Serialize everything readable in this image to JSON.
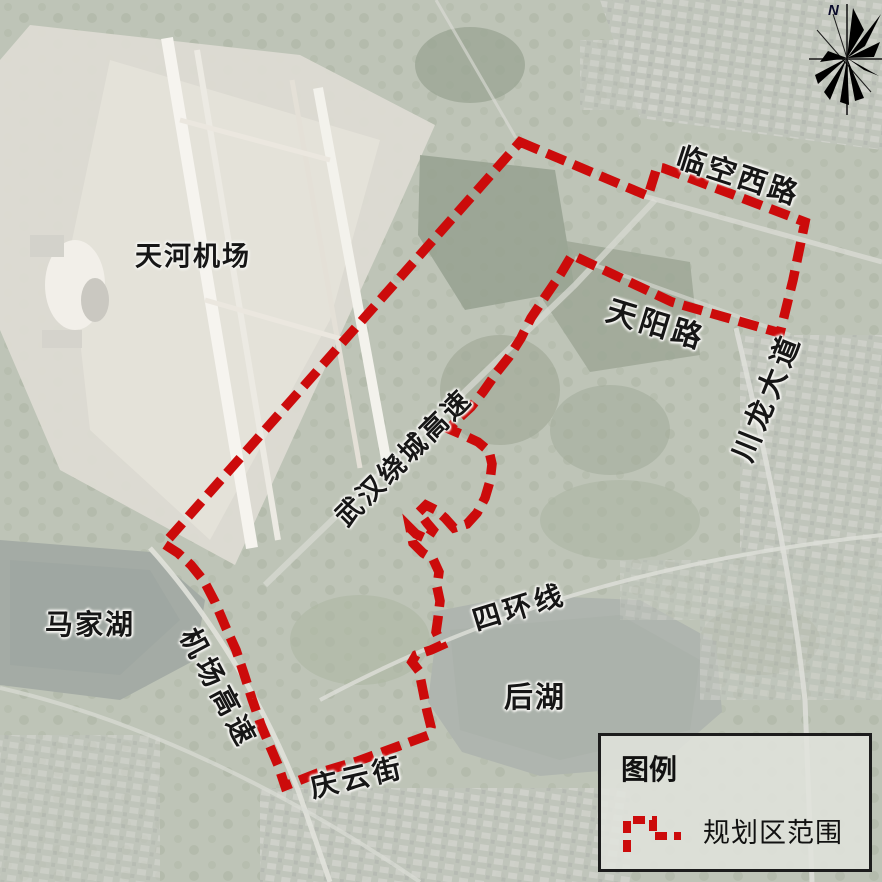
{
  "map": {
    "type": "satellite-planning-map",
    "labels": {
      "tianhe_airport": "天河机场",
      "majia_lake": "马家湖",
      "hou_lake": "后湖",
      "ring_expressway": "武汉绕城高速",
      "airport_expressway": "机场高速",
      "fourth_ring_road": "四环线",
      "qingyun_street": "庆云街",
      "tianyang_road": "天阳路",
      "chuanlong_avenue": "川龙大道",
      "linkong_west_road": "临空西路"
    },
    "boundary": {
      "name": "规划区范围",
      "color": "#cc0b0b",
      "style": "thick red dashed polygon",
      "path_d": "M520,142 L648,196 L657,167 L663,168 L805,222 L793,280 L780,333 L672,302 L572,255 L560,275 L545,297 L531,318 L521,338 L509,357 L497,372 L483,392 L471,407 L457,420 L449,429 L463,435 L478,442 L489,451 L492,464 L490,481 L485,498 L477,513 L467,524 L454,528 L445,518 L436,510 L426,505 L419,512 L427,523 L433,530 L427,539 L416,534 L410,528 L413,543 L423,553 L433,559 L439,572 L437,587 L440,601 L438,618 L436,632 L442,645 L431,650 L416,655 L412,662 L419,671 L423,691 L427,711 L431,727 L429,735 L399,746 L358,761 L318,773 L285,786 L278,765 L269,744 L261,725 L252,699 L245,677 L236,650 L226,628 L215,602 L204,581 L191,565 L178,553 L164,544 Z"
    }
  },
  "legend": {
    "title": "图例",
    "items": [
      {
        "symbol": "red-dashed-boundary-sample",
        "label": "规划区范围"
      }
    ]
  },
  "compass": {
    "north_label": "N"
  }
}
